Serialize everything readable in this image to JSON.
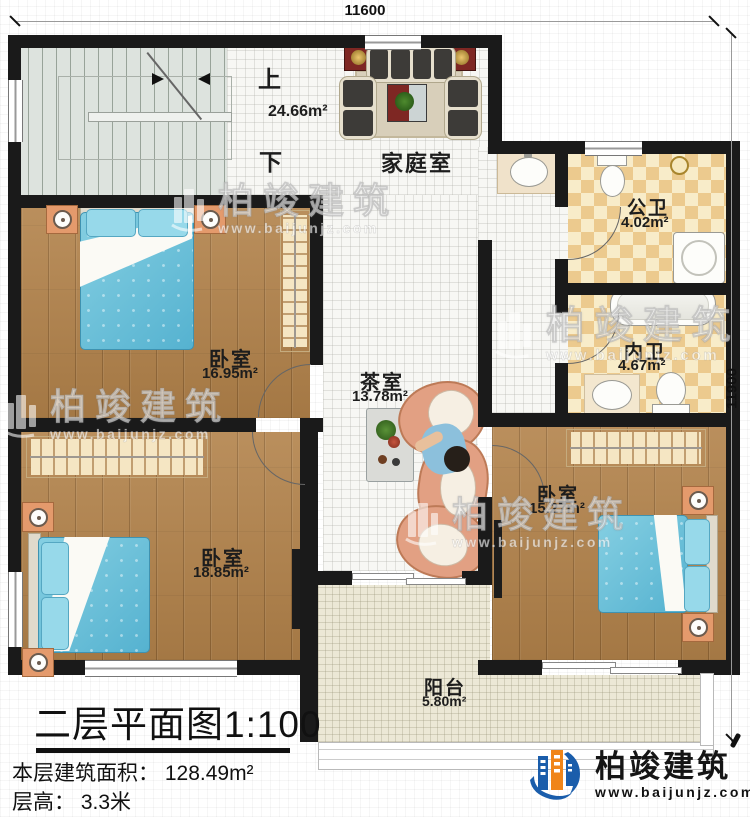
{
  "plan": {
    "dimensions": {
      "top": "11600",
      "right": "11900"
    },
    "stairs": {
      "up": "上",
      "down": "下"
    },
    "rooms": {
      "family_room": {
        "name": "家庭室",
        "area": "24.66m²"
      },
      "public_bath": {
        "name": "公卫",
        "area": "4.02m²"
      },
      "inner_bath": {
        "name": "内卫",
        "area": "4.67m²"
      },
      "bedroom_top_left": {
        "name": "卧室",
        "area": "16.95m²"
      },
      "tea_room": {
        "name": "茶室",
        "area": "13.78m²"
      },
      "bedroom_bottom_left": {
        "name": "卧室",
        "area": "18.85m²"
      },
      "bedroom_right": {
        "name": "卧室",
        "area": "15.27m²"
      },
      "balcony": {
        "name": "阳台",
        "area": "5.80m²"
      }
    }
  },
  "title_block": {
    "title": "二层平面图1:100",
    "floor_area": "本层建筑面积： 128.49m²",
    "floor_height": "层高： 3.3米"
  },
  "branding": {
    "company": "柏竣建筑",
    "website": "www.baijunjz.com"
  },
  "watermark": {
    "company": "柏竣建筑",
    "website": "www.baijunjz.com"
  },
  "colors": {
    "wall": "#1a1a1a",
    "wood_floor": "#b2824a",
    "bath_tile": "#ecca8e",
    "bed_blue": "#6fc3da",
    "brand_blue": "#1a5dab",
    "brand_orange": "#f08519"
  }
}
